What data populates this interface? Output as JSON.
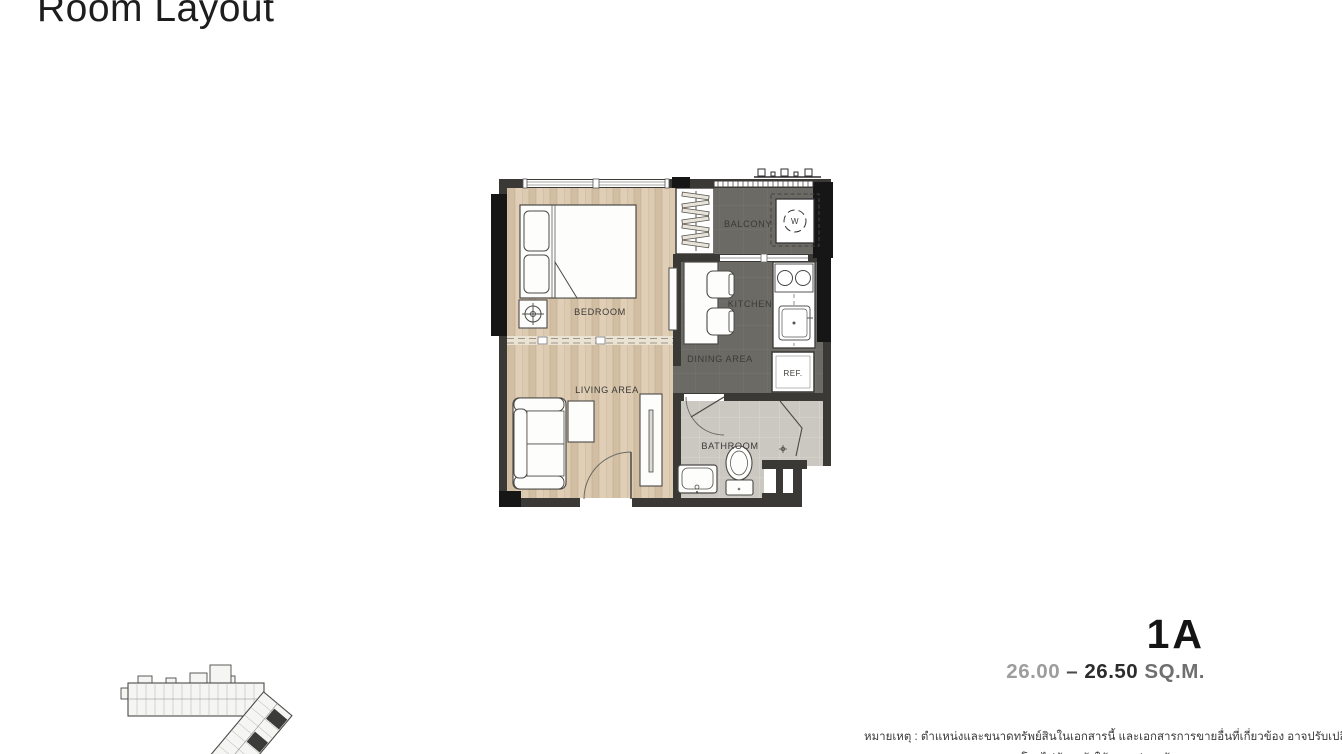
{
  "page": {
    "title": "Room Layout"
  },
  "unit": {
    "name": "1A",
    "area_parts": [
      {
        "text": "26.00"
      },
      {
        "text": " – "
      },
      {
        "text": "26.50 "
      },
      {
        "text": "SQ.M."
      }
    ]
  },
  "plan": {
    "rooms": {
      "bedroom": "BEDROOM",
      "living": "LIVING AREA",
      "dining": "DINING AREA",
      "kitchen": "KITCHEN",
      "balcony": "BALCONY",
      "bathroom": "BATHROOM"
    },
    "appliances": {
      "washer": "W",
      "fridge": "REF."
    }
  },
  "site_plan": {
    "highlight_color": "#3b3b39"
  },
  "disclaimer": {
    "line1": "หมายเหตุ : ตำแหน่งและขนาดทรัพย์สินในเอกสารนี้ และเอกสารการขายอื่นที่เกี่ยวข้อง อาจปรับเปลี่ยนได้",
    "line2": "โดยไม่ต้องแจ้งให้ทราบล่วงหน้า"
  },
  "colors": {
    "wood_floor": "#d9c7ae",
    "dark_floor": "#6b6a65",
    "tile_floor": "#cbc8c2",
    "wall": "#3b3936",
    "column": "#161616",
    "area_gray": "#9d9d9d",
    "area_dark": "#2c2c2c"
  }
}
